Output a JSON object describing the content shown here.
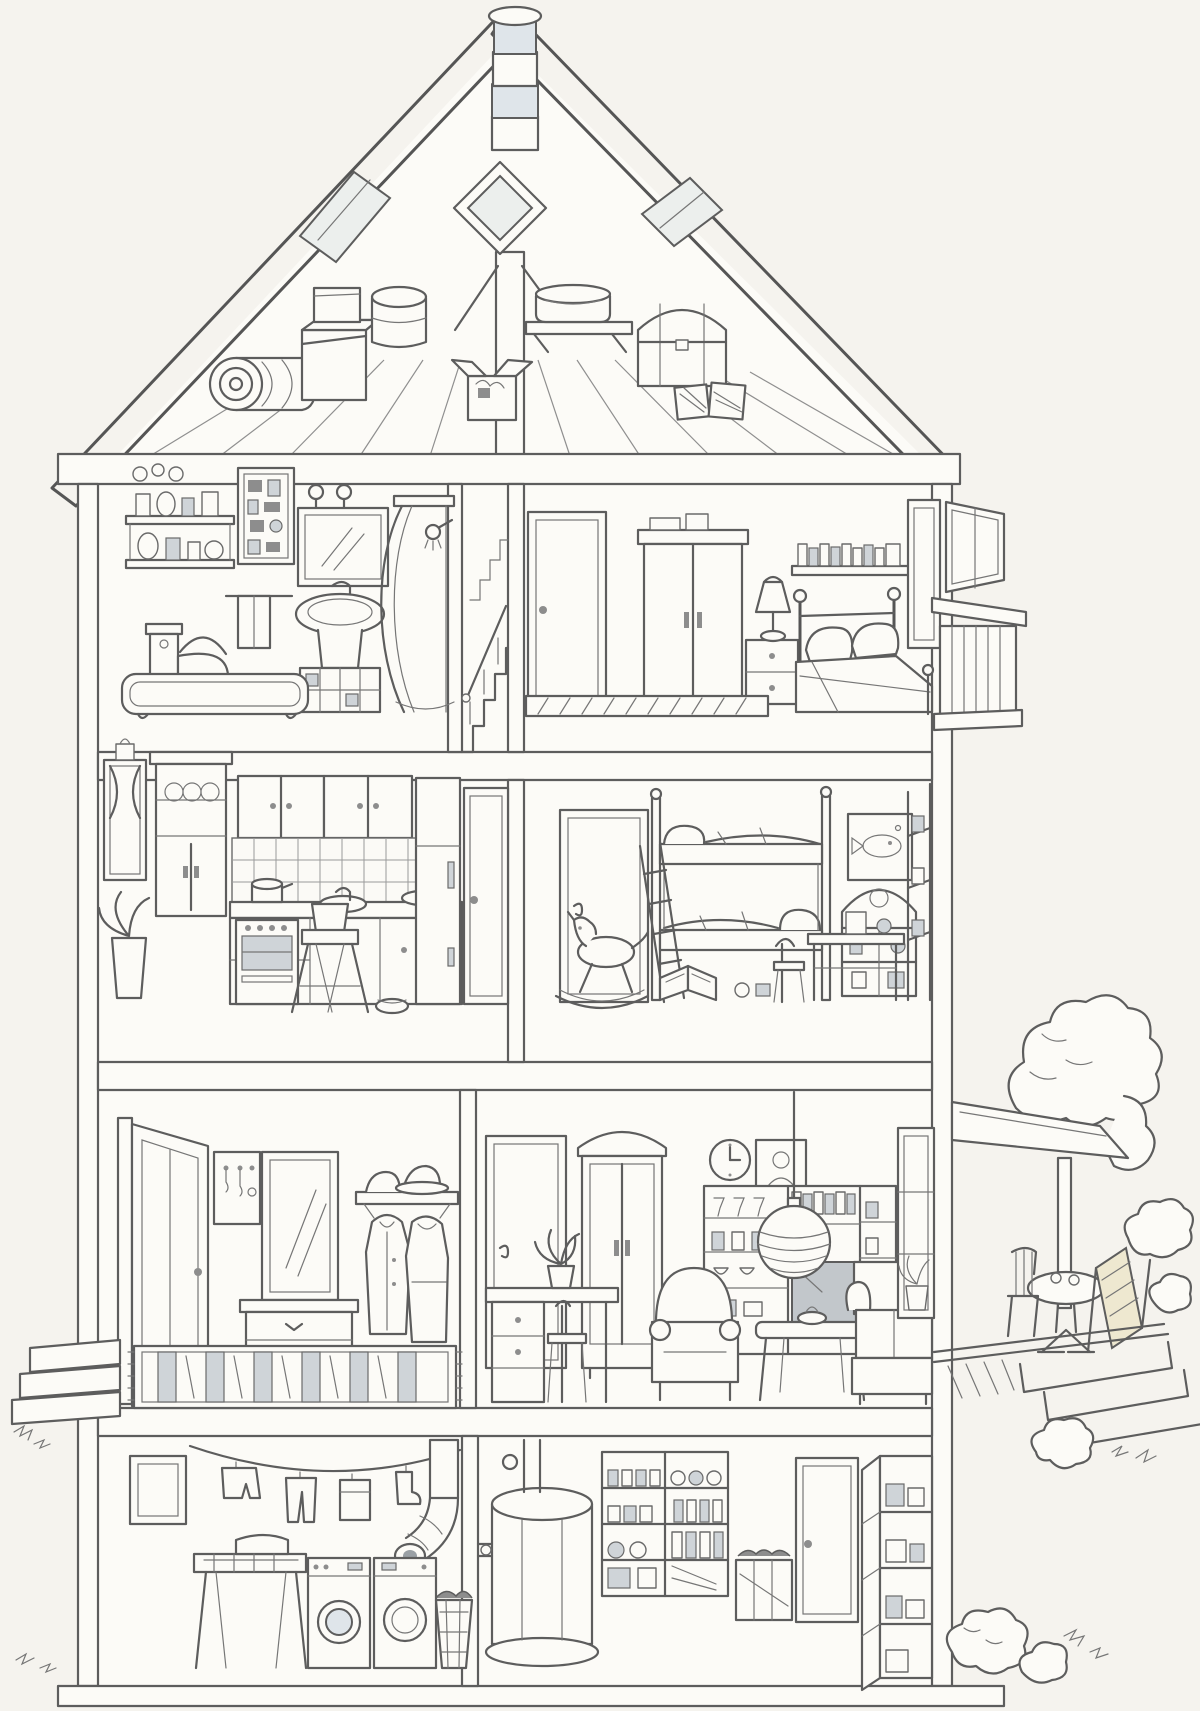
{
  "meta": {
    "title": "Cutaway dollhouse cross-section illustration",
    "medium": "black-and-white line drawing",
    "paper_color": "#f5f3ee",
    "ink_color": "#5d5d5d",
    "shade_color": "#dfe5ea"
  },
  "rooms": {
    "attic": {
      "label": "Attic",
      "items": [
        "chimney",
        "gable diamond window",
        "roof skylights",
        "rolled rug",
        "stacked boxes",
        "round hatbox",
        "open box",
        "shelf with basin",
        "storage trunk",
        "bundled books",
        "plank floorboards"
      ]
    },
    "bathroom": {
      "label": "Bathroom",
      "items": [
        "wall shelves with toiletries",
        "medicine cabinet",
        "wall hooks",
        "mirror",
        "towel rail",
        "pedestal sink",
        "toilet",
        "bathtub",
        "shower stall with curved door"
      ]
    },
    "staircase": {
      "label": "Staircase",
      "items": [
        "steps",
        "handrail",
        "balusters"
      ]
    },
    "bedroom": {
      "label": "Bedroom",
      "items": [
        "door",
        "wardrobe",
        "nightstand",
        "table lamp",
        "book shelf",
        "double bed with pillows",
        "open window",
        "striped rug"
      ]
    },
    "kitchen": {
      "label": "Kitchen",
      "items": [
        "window with curtains",
        "flower pot",
        "houseplant",
        "dresser cupboard with plates",
        "wall cabinets",
        "tiled splashback",
        "sink",
        "counter with pot and bowl",
        "stove with oven",
        "high chair",
        "pet bowl",
        "pantry cupboard",
        "door"
      ]
    },
    "kids_room": {
      "label": "Children's room",
      "items": [
        "door",
        "bunk bed with ladder",
        "fish picture",
        "toy house shelf",
        "rocking horse",
        "open book",
        "desk with chair",
        "corner shelf",
        "toys"
      ]
    },
    "hallway": {
      "label": "Entrance hall",
      "items": [
        "open front door",
        "key rack",
        "mirror",
        "chest of drawers",
        "hat shelf with two hats",
        "hanging coats",
        "shoes",
        "striped runner rug"
      ]
    },
    "living_room": {
      "label": "Living room",
      "items": [
        "door",
        "display armoire",
        "wall clock",
        "portrait",
        "shelving wall unit",
        "stemware and jars",
        "books",
        "television",
        "striped globe pendant lamp",
        "desk with plant and chair",
        "armchair",
        "coffee table",
        "sofa",
        "window with plant"
      ]
    },
    "laundry": {
      "label": "Basement laundry",
      "items": [
        "cellar window",
        "clothesline with laundry",
        "air duct with elbow",
        "wash table with basin",
        "washing machine",
        "tumble dryer",
        "laundry basket"
      ]
    },
    "cellar": {
      "label": "Basement storage",
      "items": [
        "water heater with pipes",
        "preserve shelves with jars",
        "wooden crate",
        "door",
        "storage rack"
      ]
    }
  },
  "exterior": {
    "label": "Exterior",
    "items": [
      "segmented chimney",
      "two roof skylights",
      "slatted balcony",
      "porch awning with post",
      "garden tree",
      "bistro table",
      "deck chair",
      "patio with steps",
      "front stoop with steps",
      "garden bushes",
      "ground line"
    ]
  }
}
